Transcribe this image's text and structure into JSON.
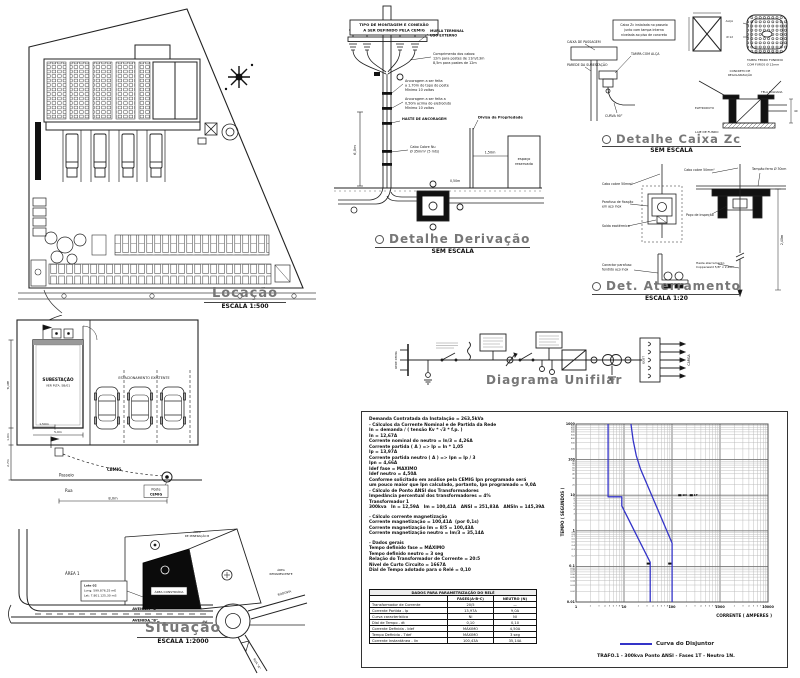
{
  "locacao": {
    "title": "Locação",
    "scale": "ESCALA 1:500"
  },
  "derivacao": {
    "title": "Detalhe Derivação",
    "scale": "SEM ESCALA",
    "note1": "TIPO DE MONTAGEM E CONEXÃO",
    "note2": "A SER DEFINIDO PELA CEMIG",
    "mufla1": "MUFLA TERMINAL",
    "mufla2": "USO EXTERNO",
    "cab1": "Comprimento dos cabos:",
    "cab2": "12m para postes de 11m/13m",
    "cab3": "8,5m para postes de 12m",
    "anc1a": "Ancoragem a ser feita",
    "anc1b": "a 1,70m do topo do poste",
    "anc1c": "Mínimo 10 voltas",
    "anc2a": "Ancoragem a ser feita a",
    "anc2b": "0,50m acima do eletroduto",
    "anc2c": "Mínimo 10 voltas",
    "haste": "HASTE DE ANCORAGEM",
    "cabo1": "Cabo Cobre Nu",
    "cabo2": "Ø 35mm² (5 mts)",
    "divisa": "Divisa da Propriedade",
    "espaco1": "espaço",
    "espaco2": "reservado",
    "d6": "6,0m",
    "d150": "1,50m",
    "d050": "0,50m"
  },
  "caixa": {
    "title": "Detalhe Caixa Zc",
    "scale": "SEM ESCALA",
    "note1": "Caixa Zc instalada no passeio",
    "note2": "junto com tampa interna",
    "note3": "nivelada ao piso de concreto",
    "l1": "CAIXA DE PASSAGEM",
    "l2": "PAREDE DA SUBESTAÇÃO",
    "l3": "CURVA 90°",
    "l4": "TAMPA COM ALÇA",
    "alca": "ALÇA",
    "furo": "Ø 12",
    "grate1": "TAMPA FERRO FUNDIDO",
    "grate2": "COM FUROS Ø 12mm",
    "tr1a": "CONCRETO DE",
    "tr1b": "REGULARIZAÇÃO",
    "tr2": "LAJE DE FUNDO",
    "tr3": "TELA SOLDADA",
    "tr4": "ELETRODUTO",
    "d40": "40"
  },
  "aterramento": {
    "title": "Det. Aterramento",
    "scale": "ESCALA 1:20",
    "cabo": "Cabo cobre 50mm²",
    "par1": "Parafuso de fixação",
    "par2": "em aço inox",
    "solda": "Solda exotérmica",
    "con1": "Conector parafuso",
    "con2": "fendido aço inox",
    "tampao": "Tampão ferro Ø 30cm",
    "poco": "Poço de inspeção",
    "haste1": "Haste aterramento",
    "haste2": "Copperweld 5/8\" x 2,40m",
    "d240": "2,40m"
  },
  "unifilar": {
    "title": "Diagrama Unifilar",
    "rede": "REDE CEMIG",
    "qgbt": "QGBT",
    "carga": "CARGA"
  },
  "subplan": {
    "room1": "SUBESTAÇÃO",
    "room2": "VER PLTA. SB/01",
    "estac": "ESTACIONAMENTO EXISTENTE",
    "passeio": "Passeio",
    "rua": "Rua",
    "cemig": "CEMIG",
    "poste1": "Poste",
    "poste2": "CEMIG",
    "d6": "6,0m",
    "d1": "1,0m",
    "d27": "2,7m",
    "d8": "8,0m",
    "d5": "5,0m",
    "d150": "1,50m"
  },
  "situacao": {
    "title": "Situação",
    "scale": "ESCALA 1:2000",
    "av": "AVENIDA \"B\"",
    "area1": "ÁREA 1",
    "min1": "ÁREA",
    "min2": "DE MINERAÇÃO B",
    "rem1": "ÁREA",
    "rem2": "REMANESCENTE",
    "constr": "ÁREA CONSTRUÍDA",
    "lote": "Lote 02",
    "long": "Long: 599.876,25 mE",
    "lat": "Lat: 7.801.125,30 mS",
    "rodovia": "RODOVIA",
    "rua_a": "RUA \"A\""
  },
  "calc": {
    "lines": [
      "Demanda Contratada da Instalação = 263,5kVa",
      "- Cálculos da Corrente Nominal e de Partida da Rede",
      "In = demanda / ( tensão Kv * √3 * f.p. )",
      "In = 12,67A",
      "Corrente nominal do neutro = In/3 = 4,26A",
      "Corrente partida ( A ) => Ip = In * 1,05",
      "Ip = 13,97A",
      "Corrente partida neutro ( A ) => Ipn = Ip / 3",
      "Ipn = 4,66A",
      "Idef fase = MAXIMO",
      "Idef neutro = 4,50A",
      "Conforme solicitado em análise pela CEMIG Ipn programado será",
      "um pouco maior que Ipn calculado, portanto, Ipn programado = 9,0A",
      "- Cálculo de Ponto ANSI dos Transformadores",
      "Impedância percentual dos transformadores = 4%",
      "Transformador 1",
      "300kva   In = 12,59A   Im = 100,41A   ANSI = 251,83A   ANSIn = 145,39A",
      "",
      "- Cálculo corrente magnetização",
      "Corrente magnetização = 100,41A  (por 0,1s)",
      "Corrente magnetização Im = 8/5 = 100,43A",
      "Corrente magnetização neutro = Im/3 = 35,14A",
      "",
      "- Dados gerais",
      "Tempo definido fase = MÁXIMO",
      "Tempo definido neutro = 3 seg",
      "Relação do Transformador de Corrente = 20:5",
      "Nível de Curto Circuito = 1667A",
      "Dial de Tempo adotado para o Relé = 0,10"
    ]
  },
  "relay_table": {
    "title": "DADOS PARA PARAMETRIZAÇÃO DO RELÉ",
    "col_fase": "FASES(A-B-C)",
    "col_neutro": "NEUTRO (N)",
    "rows": [
      [
        "Transformador de Corrente",
        "20/5",
        "—"
      ],
      [
        "Corrente Partida - Ip",
        "13,97A",
        "9,0A"
      ],
      [
        "Curva característica",
        "NI",
        "NI"
      ],
      [
        "Dial de Tempo - dt",
        "0,10",
        "0,10"
      ],
      [
        "Corrente Definida - Idef",
        "MÁXIMO",
        "4,50A"
      ],
      [
        "Tempo Definido - Tdef",
        "MÁXIMO",
        "3 seg"
      ],
      [
        "Corrente Instantânea - Iin",
        "100,43A",
        "35,14A"
      ]
    ]
  },
  "chart": {
    "ylabel": "TEMPO ( SEGUNDOS )",
    "xlabel": "CORRENTE ( AMPERES )",
    "legend": "Curva do Disjuntor",
    "caption": "TRAFO.1 - 300kva      Ponto ANSI  -  Fases 1T  -  Neutro 1N."
  },
  "chart_data": {
    "type": "line",
    "xscale": "log",
    "yscale": "log",
    "xlim": [
      1,
      10000
    ],
    "ylim": [
      0.01,
      1000
    ],
    "grid": true,
    "xlabel": "CORRENTE ( AMPERES )",
    "ylabel": "TEMPO ( SEGUNDOS )",
    "legend_position": "bottom",
    "series": [
      {
        "name": "Curva do Disjuntor - Neutro",
        "color": "#3434c8",
        "points": [
          [
            4.66,
            1000
          ],
          [
            4.66,
            9
          ],
          [
            9,
            9
          ],
          [
            9,
            5
          ],
          [
            35.14,
            0.13
          ],
          [
            35.14,
            0.01
          ]
        ]
      },
      {
        "name": "Curva do Disjuntor - Fase",
        "color": "#3434c8",
        "points": [
          [
            13.97,
            1000
          ],
          [
            15.5,
            350
          ],
          [
            18,
            130
          ],
          [
            22,
            55
          ],
          [
            100.43,
            0.45
          ],
          [
            100.43,
            0.01
          ]
        ]
      }
    ],
    "markers": [
      {
        "x": 32,
        "y": 0.12,
        "label": ""
      },
      {
        "x": 90,
        "y": 0.12,
        "label": ""
      },
      {
        "x": 145.39,
        "y": 10,
        "label": "1N"
      },
      {
        "x": 251.83,
        "y": 10,
        "label": "1T"
      }
    ]
  }
}
